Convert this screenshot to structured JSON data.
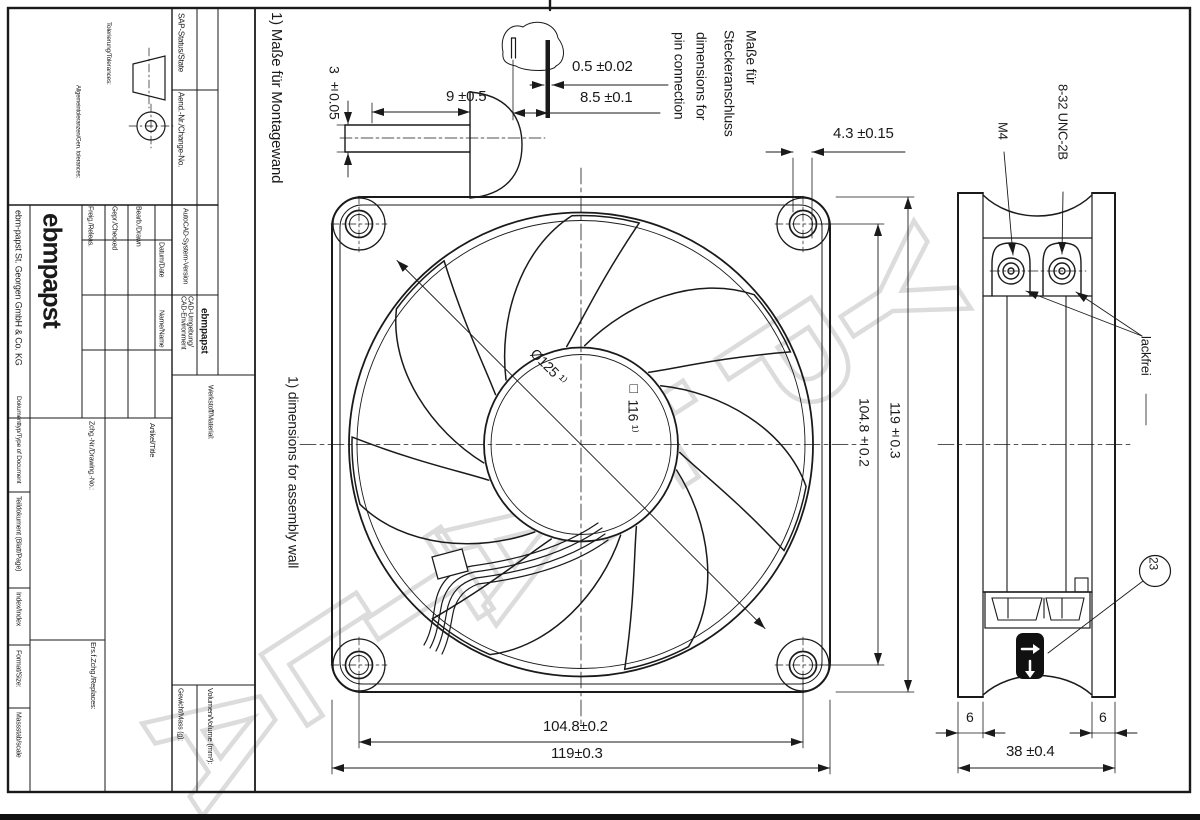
{
  "watermark": "ALTAE.PY",
  "title_block": {
    "sap_status": "SAP-Status/State",
    "change_no": "Aend.-Nr./Change-No.",
    "autocad_version": "AutoCAD-System-Version",
    "cad_env": "CAD-Umgebung/\nCAD-Environment",
    "cad_env_value": "ebmpapst",
    "material": "Werkstoff/Material:",
    "tolerances": "Tolerierung/Tolerances:",
    "gen_tolerances": "Allgemeintoleranzen/Gen. tolerances:",
    "drawn": "Bearb./Drawn",
    "checked": "Gepr./Checked",
    "released": "Freig./Releas.",
    "date": "Datum/Date",
    "name": "Name/Name",
    "logo": "ebmpapst",
    "company": "ebm-papst St. Georgen GmbH & Co. KG",
    "drawing_no": "Zchg.-Nr./Drawing.-No.:",
    "title": "Artikel/Title",
    "replaces": "Ers.f.Zchg./Replaces:",
    "doc_type": "Dokumenttyp/Type of Document",
    "part_doc": "Teildokument (Blatt/Page)",
    "index": "Index/Index",
    "format": "Format/Size:",
    "scale": "Massstab/scale",
    "volume": "Volumen/Volume (mm³):",
    "mass": "Gewicht/Mass (g):"
  },
  "notes": {
    "assembly_de": "1) Maße für Montagewand",
    "assembly_en": "1) dimensions for assembly wall",
    "pin_de_1": "Maße für",
    "pin_de_2": "Steckeranschluss",
    "pin_en_1": "dimensions for",
    "pin_en_2": "pin connection",
    "m4": "M4",
    "unc": "8-32 UNC-2B",
    "lackfrei": "lackfrei",
    "balloon": "23"
  },
  "dimensions": {
    "stud_dia": "3 ±0.05",
    "stud_len": "9 ±0.5",
    "pin_thk": "0.5 ±0.02",
    "pin_pitch": "8.5 ±0.1",
    "hole_dia": "4.3 ±0.15",
    "hole_pitch": "104.8±0.2",
    "frame_size": "119±0.3",
    "depth": "38 ±0.4",
    "flange": "6",
    "wall_hole": "Ø125 ¹⁾",
    "wall_square": "□ 116 ¹⁾"
  }
}
